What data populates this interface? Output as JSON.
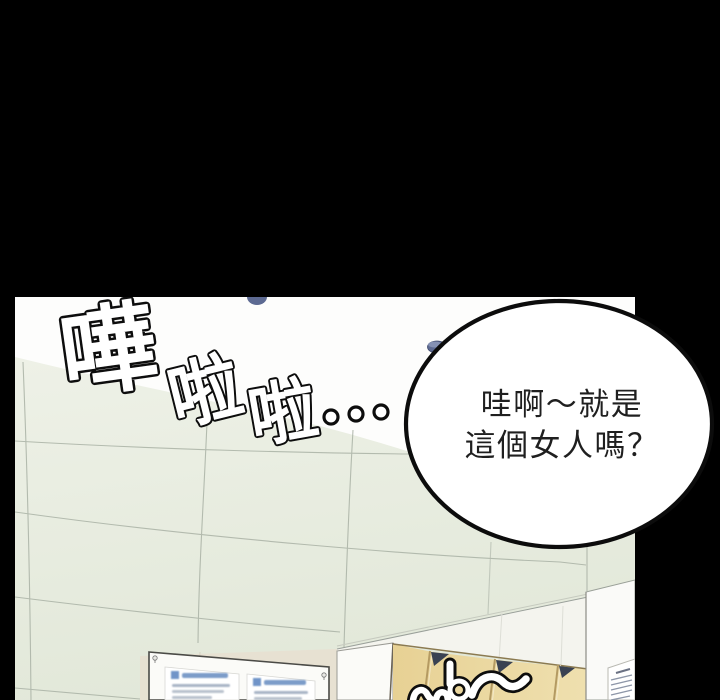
{
  "comic_panel": {
    "sfx_splash": {
      "c1": "嘩",
      "c2": "啦",
      "c3": "啦",
      "trailing_dots": "…"
    },
    "speech_bubble": {
      "line1": "哇啊～就是",
      "line2": "這個女人嗎？"
    },
    "bottom_sfx_partial": "嘩～",
    "scene": {
      "notice_board_posters": 2,
      "locker_doors": 4,
      "pillar_notice_lines": 5
    },
    "colors": {
      "background_black": "#000000",
      "wall_white": "#fdfdfc",
      "tile_green": "#e9ede2",
      "tile_seam": "#a9b1a5",
      "beige_wall": "#e7e1d2",
      "locker_tan": "#ecd9a2",
      "locker_shadow_navy": "#3a4252",
      "ceiling_fixture_blue": "#5d6a92",
      "bubble_fill": "#ffffff",
      "bubble_stroke": "#0c0c0c"
    }
  }
}
